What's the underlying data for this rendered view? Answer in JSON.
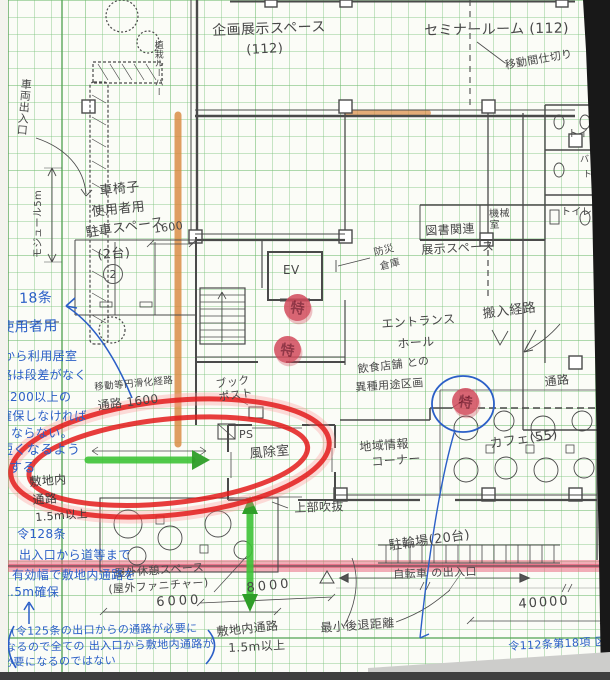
{
  "rooms": {
    "planned_exhibition": "企画展示スペース",
    "planned_exhibition_capacity": "(112)",
    "seminar_room": "セミナールーム (112)",
    "movable_partition": "移動間仕切り",
    "wheelchair_l1": "車椅子",
    "wheelchair_l2": "使用者用",
    "wheelchair_l3": "駐車スペース",
    "wheelchair_l4": "(2台)",
    "ev": "EV",
    "disaster_l1": "防災",
    "disaster_l2": "倉庫",
    "entrance_l1": "エントランス",
    "entrance_l2": "ホール",
    "library_l1": "図書関連",
    "library_l2": "展示スペース",
    "machine_room": "機械室",
    "toilet_top": "トイレ",
    "toilet_bf_l1": "バリ",
    "toilet_bf_l2": "トイ",
    "toilet_mid": "トイレ",
    "carry_in_route": "搬入経路",
    "restaurant_l1": "飲食店舗 との",
    "restaurant_l2": "異種用途区画",
    "local_info_l1": "地域情報",
    "local_info_l2": "コーナー",
    "windbreak_room": "風除室",
    "ps": "PS",
    "bookpost_l1": "ブック",
    "bookpost_l2": "ポスト",
    "void_above": "上部吹抜",
    "cafe": "カフェ(55)",
    "corridor": "通路",
    "bicycle_parking": "駐輪場(20台)",
    "bicycle_entrance": "自転車 の出入口",
    "min_setback": "最小後退距離",
    "site_path_l1": "敷地内通路",
    "site_path_l2": "1.5m以上",
    "outdoor_rest_l1": "屋外休憩スペース",
    "outdoor_rest_l2": "(屋外ファニチャー)",
    "vehicle_entrance": "車両出入口",
    "module_5m": "モジュール5m",
    "planting_louver": "植栽ルーバー",
    "barrier_free_route": "移動等円滑化経路",
    "path_1600": "通路 1600",
    "site_path_left_l1": "敷地内",
    "site_path_left_l2": "通路",
    "site_path_left_l3": "1.5m以上"
  },
  "dimensions": {
    "d1600": "1600",
    "d6000": "6000",
    "d8000": "8000",
    "d40000": "40000"
  },
  "notes_blue": {
    "art18": "18条",
    "l2": "使用者用",
    "l3": "から利用居室",
    "l4": "路は段差がなく",
    "l5": "1200以上の",
    "l6": "確保しなければ",
    "l7": "ならない。",
    "l8": "短くなるよう",
    "l9": "する",
    "art128": "令128条",
    "art128_l2": "出入口から道等まで",
    "art128_l3": "有効幅で敷地内通路を",
    "art128_l4": "1.5m確保",
    "bottom_l1": "(令125条の出口からの通路が必要に",
    "bottom_l2": "なるので全ての 出入口から敷地内通路が",
    "bottom_l3": "必要になるのではない",
    "art112": "令112条第18項 区"
  },
  "stamps": {
    "fire_rated": "特"
  },
  "marks": {
    "grid_bubble": "2"
  },
  "colors": {
    "ink_blue": "#2b5fc7",
    "marker_red": "#e31b1b",
    "marker_red_glow": "#ff9a9a",
    "highlighter_orange": "#d9863b",
    "highlighter_pink": "#e75d78",
    "arrow_green": "#3ec437",
    "arrow_green_dark": "#2e9e28",
    "stamp_red": "#d24a5c",
    "stamp_text": "#7d1428",
    "pencil_gray": "#4a4a4a",
    "grid_green": "#7fc37f",
    "paper": "#fbfcf7"
  }
}
